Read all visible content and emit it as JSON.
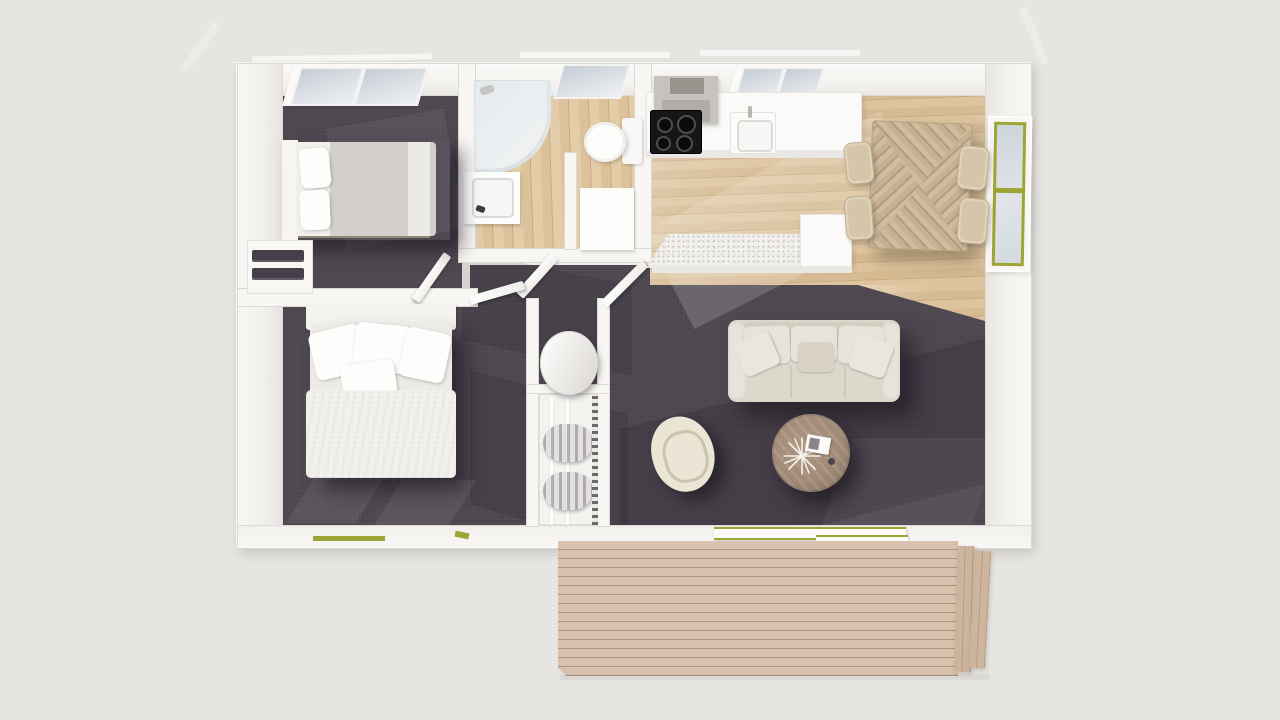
{
  "scene": {
    "description": "3D top-down architectural render of a small two-bedroom dwelling floor plan with an attached timber deck",
    "view": "overhead dollhouse render",
    "background_color": "#e7e5e1"
  },
  "colors": {
    "bg": "#e7e5e1",
    "wall": "#f7f6f3",
    "wall-edge": "#ddd9d4",
    "carpet": "#4e4750",
    "carpet-dark": "#3b3540",
    "wood": "#ddc49e",
    "wood-line": "#c9ac82",
    "deck": "#d8c2ae",
    "deck-line": "#ae9480",
    "deck-step": "#ccb49d",
    "green": "#9da635",
    "glass": "#ccd3da",
    "sofa": "#dcd8cc",
    "sofa-light": "#e7e3da",
    "sofa-mid": "#d2cec2",
    "cream": "#ebe5d6",
    "chair": "#d6c6a9",
    "dtable": "#c6b192",
    "dtable-dark": "#b49c7c",
    "ctable": "#a18a76",
    "duvet": "#d3d0cb",
    "dark-items": "#45404a",
    "cooktop": "#171617",
    "hood": "#c6c3bf",
    "hood-dark": "#b0ada8"
  },
  "rooms": [
    {
      "id": "bedroom-1",
      "floor": "dark carpet",
      "contents": [
        "double bed with grey duvet",
        "open wardrobe shelf with dark clothing",
        "skylight"
      ]
    },
    {
      "id": "bedroom-2",
      "floor": "dark carpet",
      "contents": [
        "double bed with white linen and pillows",
        "windows with olive frames"
      ]
    },
    {
      "id": "bathroom",
      "floor": "timber",
      "contents": [
        "curved corner shower",
        "vanity sink",
        "toilet",
        "cabinet",
        "skylight"
      ]
    },
    {
      "id": "kitchen-dining",
      "floor": "timber",
      "contents": [
        "counter with cooktop and sink",
        "range hood",
        "island bench",
        "dining table with parquet top",
        "four chairs",
        "olive framed window",
        "skylight"
      ]
    },
    {
      "id": "living-room",
      "floor": "dark carpet",
      "contents": [
        "three-seat sofa",
        "round timber coffee table with starburst decor",
        "cream swivel armchair",
        "sliding glass door"
      ]
    },
    {
      "id": "hallway",
      "floor": "dark carpet",
      "contents": [
        "cylindrical water heater",
        "wardrobe with hanging clothes",
        "open doors"
      ]
    }
  ],
  "exterior": {
    "deck": "timber deck with horizontal planks and stepped side boards",
    "skylight_count": 3,
    "accent_color_use": "olive green window and door frames"
  }
}
